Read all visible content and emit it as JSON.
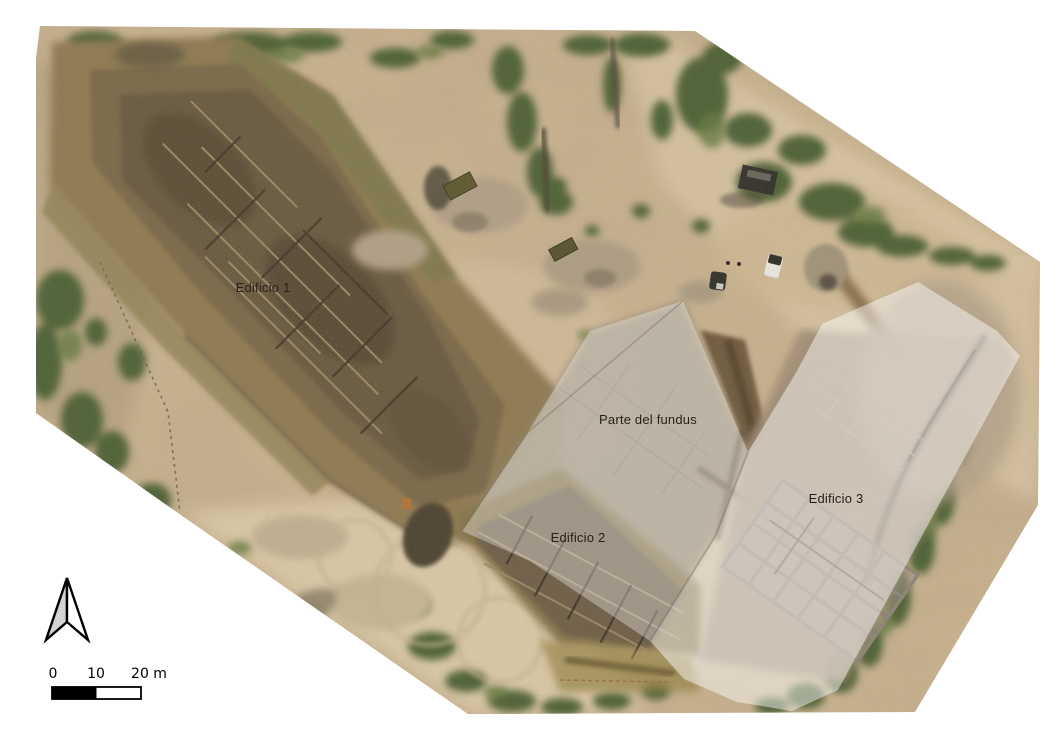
{
  "map": {
    "area_labels": [
      {
        "id": "edificio-1",
        "text": "Edificio 1"
      },
      {
        "id": "parte-del-fundus",
        "text": "Parte del fundus"
      },
      {
        "id": "edificio-2",
        "text": "Edificio 2"
      },
      {
        "id": "edificio-3",
        "text": "Edificio 3"
      }
    ],
    "label_color": "#27211a",
    "overlay_highlight_color": "#ffffff"
  },
  "north_arrow": {
    "icon": "north-arrow",
    "fill_left": "#d3d3d3",
    "fill_right": "#ffffff",
    "outline": "#000000"
  },
  "scale_bar": {
    "tick_labels": [
      "0",
      "10",
      "20 m"
    ],
    "bar_colors": [
      "#000000",
      "#ffffff"
    ],
    "outline": "#000000"
  }
}
